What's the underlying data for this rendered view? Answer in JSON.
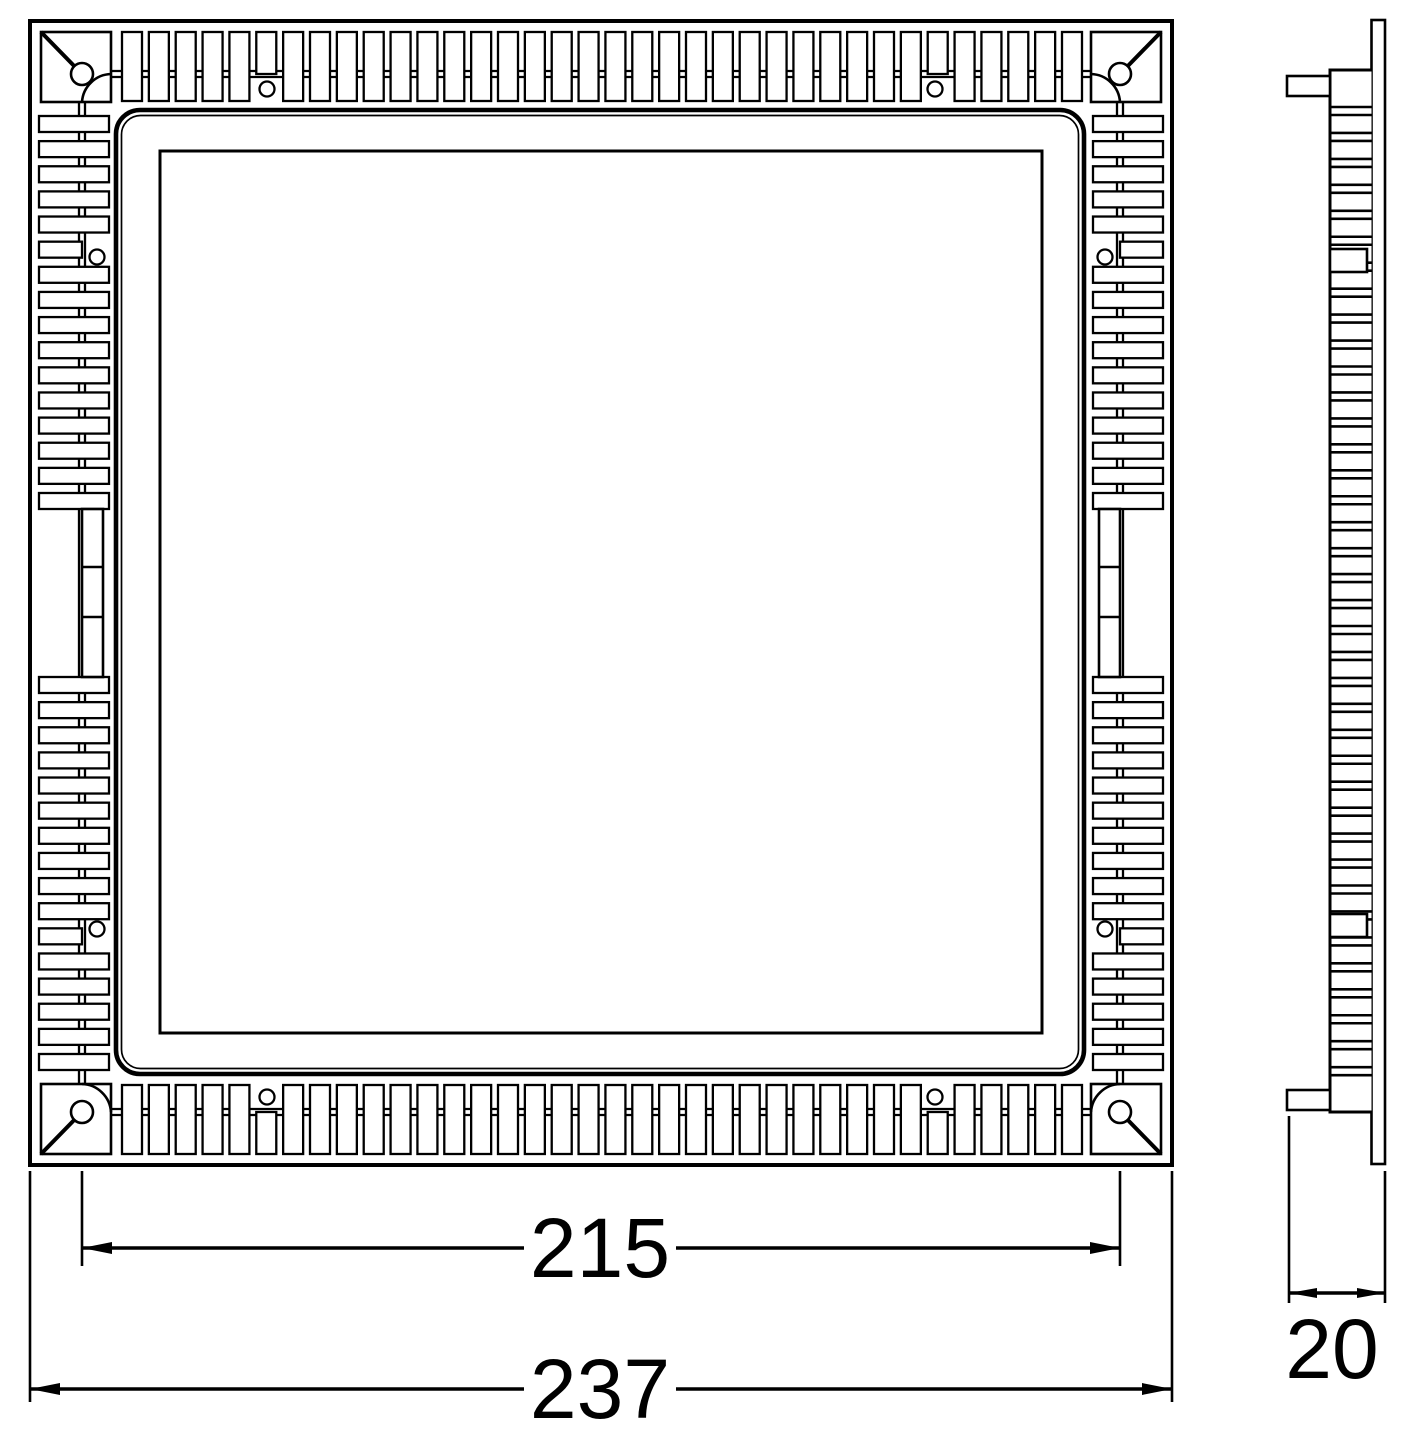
{
  "drawing": {
    "background_color": "#ffffff",
    "line_color": "#000000",
    "dimensions": {
      "inner": {
        "value": "215"
      },
      "overall": {
        "value": "237"
      },
      "depth": {
        "value": "20"
      }
    }
  }
}
